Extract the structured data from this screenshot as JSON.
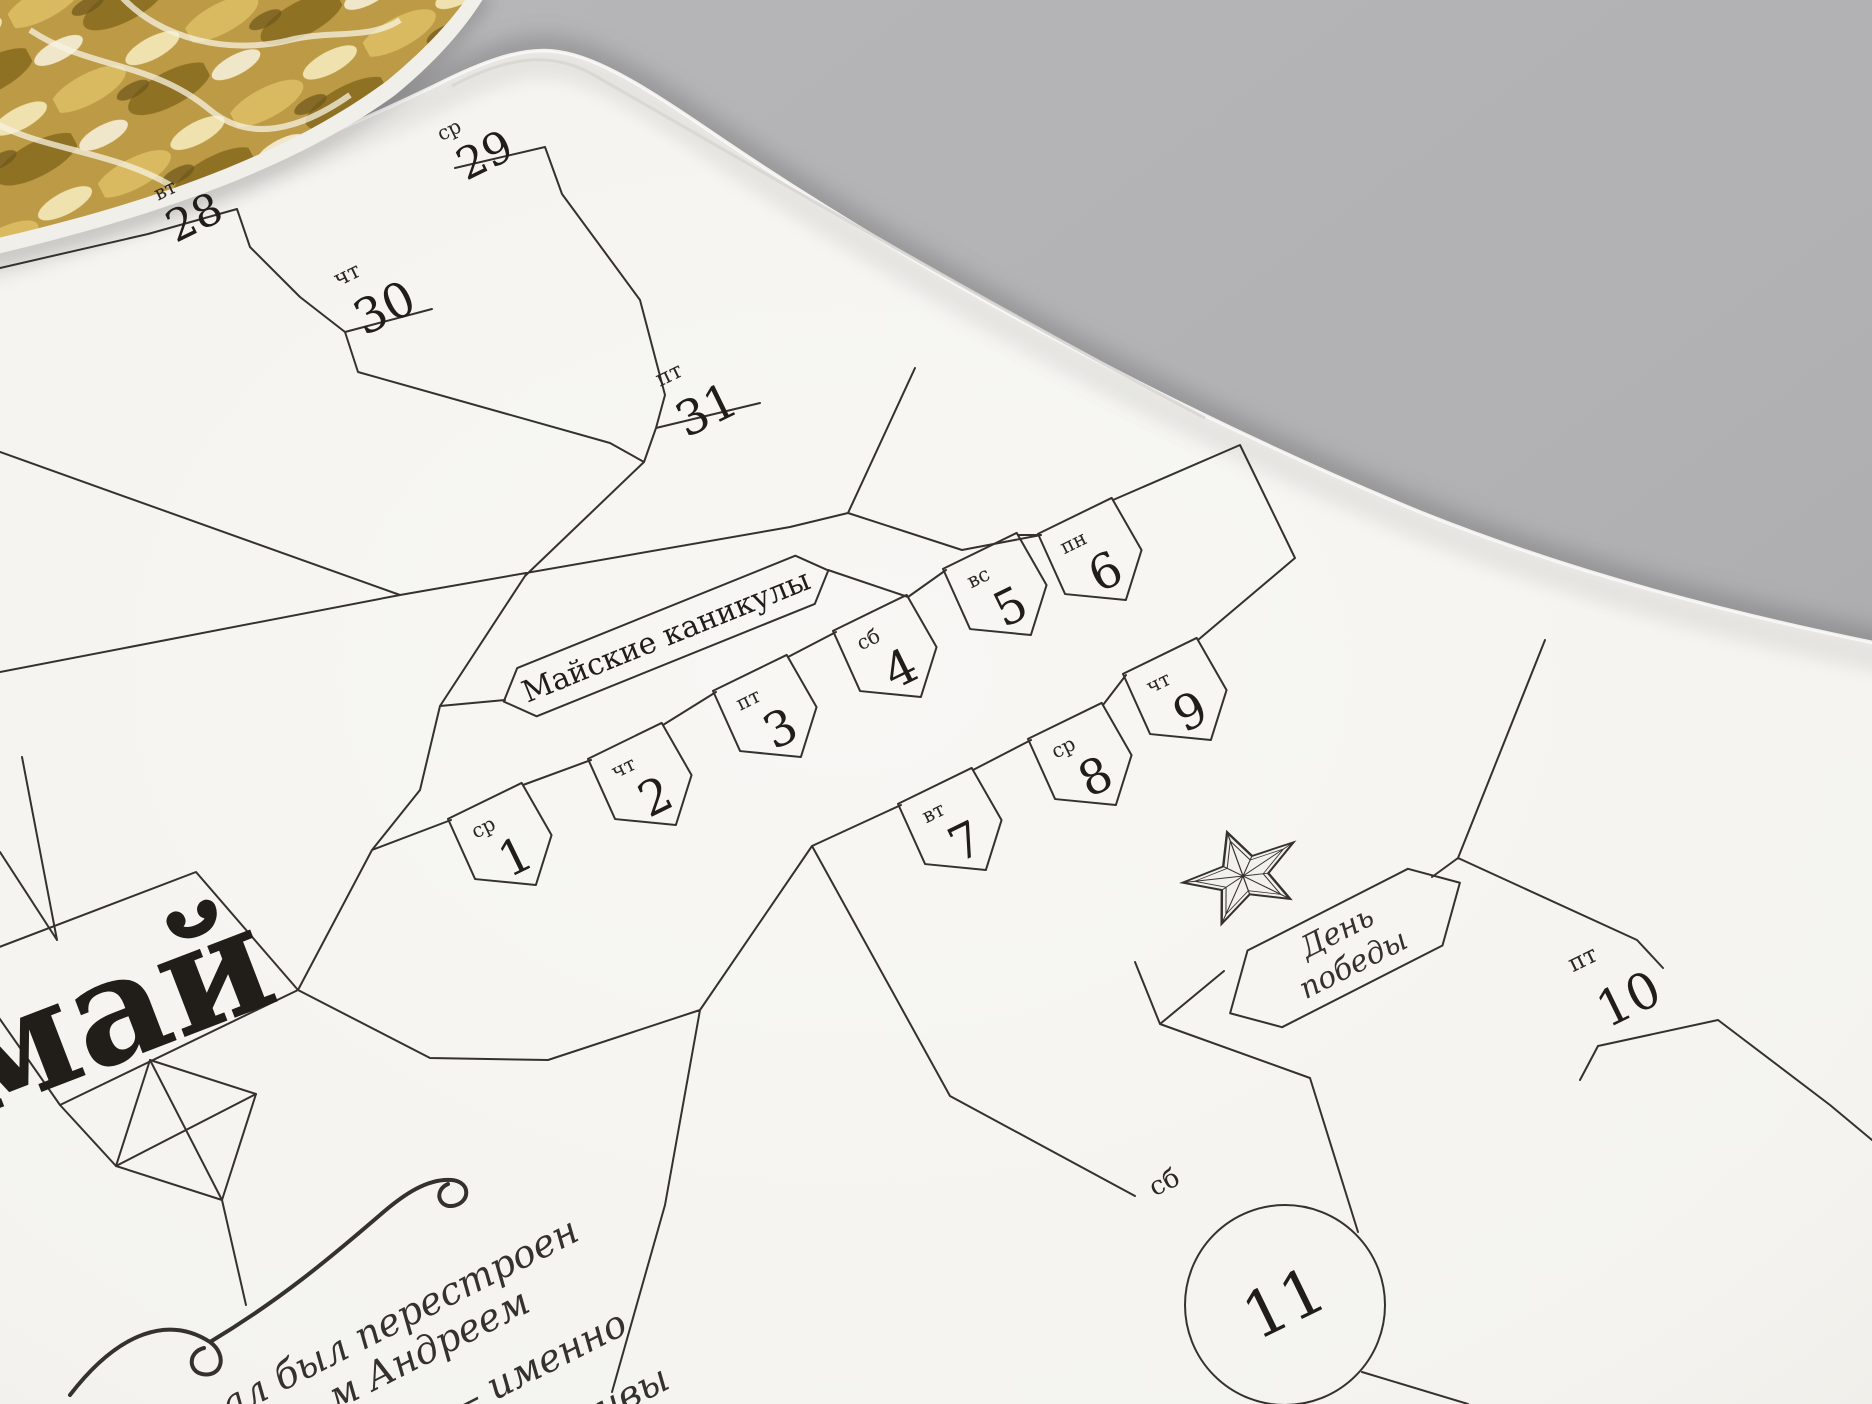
{
  "scene": {
    "background_color": "#b3b3b5",
    "page_color": "#f6f5f2",
    "ink_color": "#35322e",
    "holiday_fill": "#e7e6e2",
    "gold_color": "#bd9a45"
  },
  "calendar": {
    "month_title": "май",
    "holiday_banner": "Майские каникулы",
    "victory_day": {
      "line1": "День",
      "line2": "победы"
    },
    "dates": [
      {
        "num": "28",
        "dow": "вт"
      },
      {
        "num": "29",
        "dow": "ср"
      },
      {
        "num": "30",
        "dow": "чт"
      },
      {
        "num": "31",
        "dow": "пт"
      },
      {
        "num": "1",
        "dow": "ср"
      },
      {
        "num": "2",
        "dow": "чт"
      },
      {
        "num": "3",
        "dow": "пт"
      },
      {
        "num": "4",
        "dow": "сб"
      },
      {
        "num": "5",
        "dow": "вс"
      },
      {
        "num": "6",
        "dow": "пн"
      },
      {
        "num": "7",
        "dow": "вт"
      },
      {
        "num": "8",
        "dow": "ср"
      },
      {
        "num": "9",
        "dow": "чт",
        "holiday": true
      },
      {
        "num": "10",
        "dow": "пт"
      },
      {
        "num": "11",
        "dow": "сб"
      }
    ],
    "caption_fragments": [
      "ал был перестроен",
      "м Андреем",
      "ом — именно",
      "ивы"
    ]
  }
}
